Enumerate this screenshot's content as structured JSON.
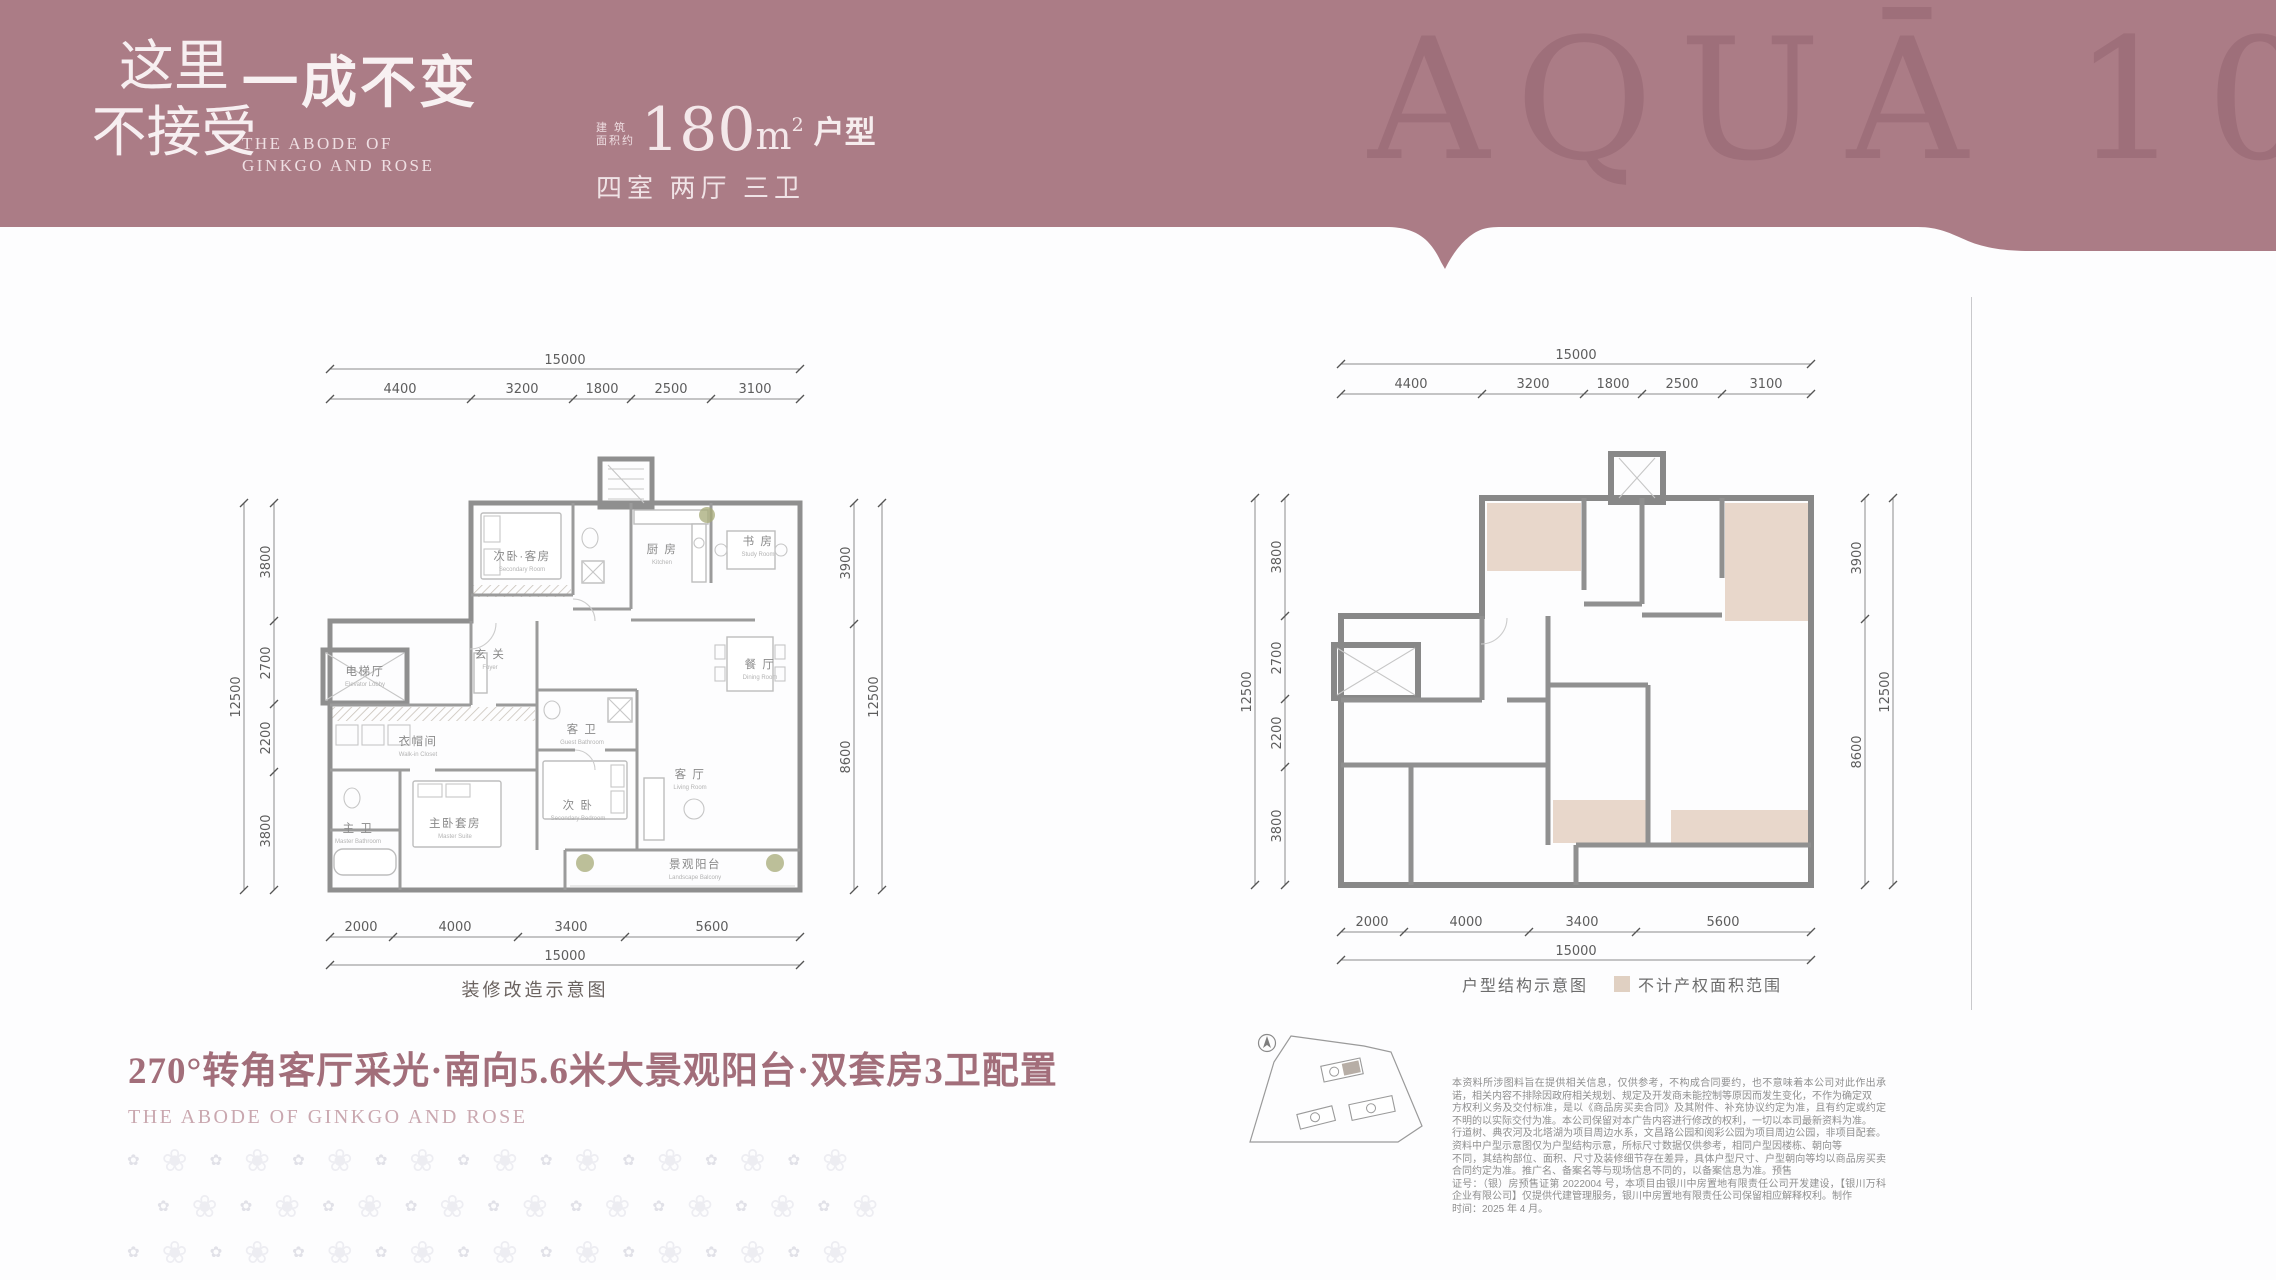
{
  "header": {
    "band_color": "#ab7c86",
    "watermark": "AQUĀ 108",
    "slogan": {
      "line1": "这里",
      "line2": "不接受"
    },
    "title": "一成不变",
    "subtitle": {
      "line1": "THE ABODE OF",
      "line2": "GINKGO AND ROSE"
    },
    "area": {
      "prefix": "建 筑\n面积约",
      "value": "180",
      "unit": "m",
      "exponent": "2",
      "suffix": "户型"
    },
    "spec": "四室 两厅 三卫"
  },
  "plans": {
    "left": {
      "caption": "装修改造示意图",
      "dims": {
        "top_total": "15000",
        "top_segments": [
          "4400",
          "3200",
          "1800",
          "2500",
          "3100"
        ],
        "left_total": "12500",
        "left_segments": [
          "3800",
          "2700",
          "2200",
          "3800"
        ],
        "right_total": "12500",
        "right_segments": [
          "3900",
          "8600"
        ],
        "bottom_total": "15000",
        "bottom_segments": [
          "2000",
          "4000",
          "3400",
          "5600"
        ]
      },
      "rooms": {
        "bedroom2": {
          "cn": "次卧·客房",
          "en": "Secondary Room"
        },
        "kitchen": {
          "cn": "厨 房",
          "en": "Kitchen"
        },
        "study": {
          "cn": "书 房",
          "en": "Study Room"
        },
        "dining": {
          "cn": "餐 厅",
          "en": "Dining Room"
        },
        "living": {
          "cn": "客 厅",
          "en": "Living Room"
        },
        "balcony": {
          "cn": "景观阳台",
          "en": "Landscape Balcony"
        },
        "bedroom3": {
          "cn": "次 卧",
          "en": "Secondary Bedroom"
        },
        "guest_bath": {
          "cn": "客 卫",
          "en": "Guest Bathroom"
        },
        "master": {
          "cn": "主卧套房",
          "en": "Master Suite"
        },
        "master_bath": {
          "cn": "主 卫",
          "en": "Master Bathroom"
        },
        "closet": {
          "cn": "衣帽间",
          "en": "Walk-in Closet"
        },
        "elevator": {
          "cn": "电梯厅",
          "en": "Elevator Lobby"
        },
        "foyer": {
          "cn": "玄 关",
          "en": "Foyer"
        }
      }
    },
    "right": {
      "caption": "户型结构示意图",
      "legend": "不计产权面积范围",
      "dims": {
        "top_total": "15000",
        "top_segments": [
          "4400",
          "3200",
          "1800",
          "2500",
          "3100"
        ],
        "left_total": "12500",
        "left_segments": [
          "3800",
          "2700",
          "2200",
          "3800"
        ],
        "right_total": "12500",
        "right_segments": [
          "3900",
          "8600"
        ],
        "bottom_total": "15000",
        "bottom_segments": [
          "2000",
          "4000",
          "3400",
          "5600"
        ]
      }
    }
  },
  "tagline": {
    "cn": "270°转角客厅采光·南向5.6米大景观阳台·双套房3卫配置",
    "en": "THE ABODE OF GINKGO AND ROSE"
  },
  "disclaimer": {
    "lines": [
      "本资料所涉图料旨在提供相关信息，仅供参考，不构成合同要约，也不意味着本公司对此作出承诺，相关内容不排除因政府相关规划、规定及开发商未能控制等原因而发生变化，不作为确定双",
      "方权利义务及交付标准，是以《商品房买卖合同》及其附件、补充协议约定为准，且有约定或约定不明的以实际交付为准。本公司保留对本广告内容进行修改的权利，一切以本司最新资料为准。",
      "行道树、典农河及北塔湖为项目周边水系，文昌路公园和阅彩公园为项目周边公园，非项目配套。资料中户型示意图仅为户型结构示意，所标尺寸数据仅供参考，相同户型因楼栋、朝向等",
      "不同，其结构部位、面积、尺寸及装修细节存在差异，具体户型尺寸、户型朝向等均以商品房买卖合同约定为准。推广名、备案名等与现场信息不同的，以备案信息为准。预售",
      "证号：（银）房预售证第 2022004 号，本项目由银川中房置地有限责任公司开发建设，【银川万科企业有限公司】仅提供代建管理服务，银川中房置地有限责任公司保留相应解释权利。制作",
      "时间：2025 年 4 月。"
    ]
  },
  "decor": {
    "flower_small": "✿",
    "flower_large": "❀",
    "count": 9
  },
  "colors": {
    "band": "#ab7c86",
    "watermark": "#8d5d69",
    "tagline": "#a26e7a",
    "beige_area": "#e8d7cb",
    "legend_box": "#e0d0c2",
    "wall_gray": "#8f8f8f"
  }
}
